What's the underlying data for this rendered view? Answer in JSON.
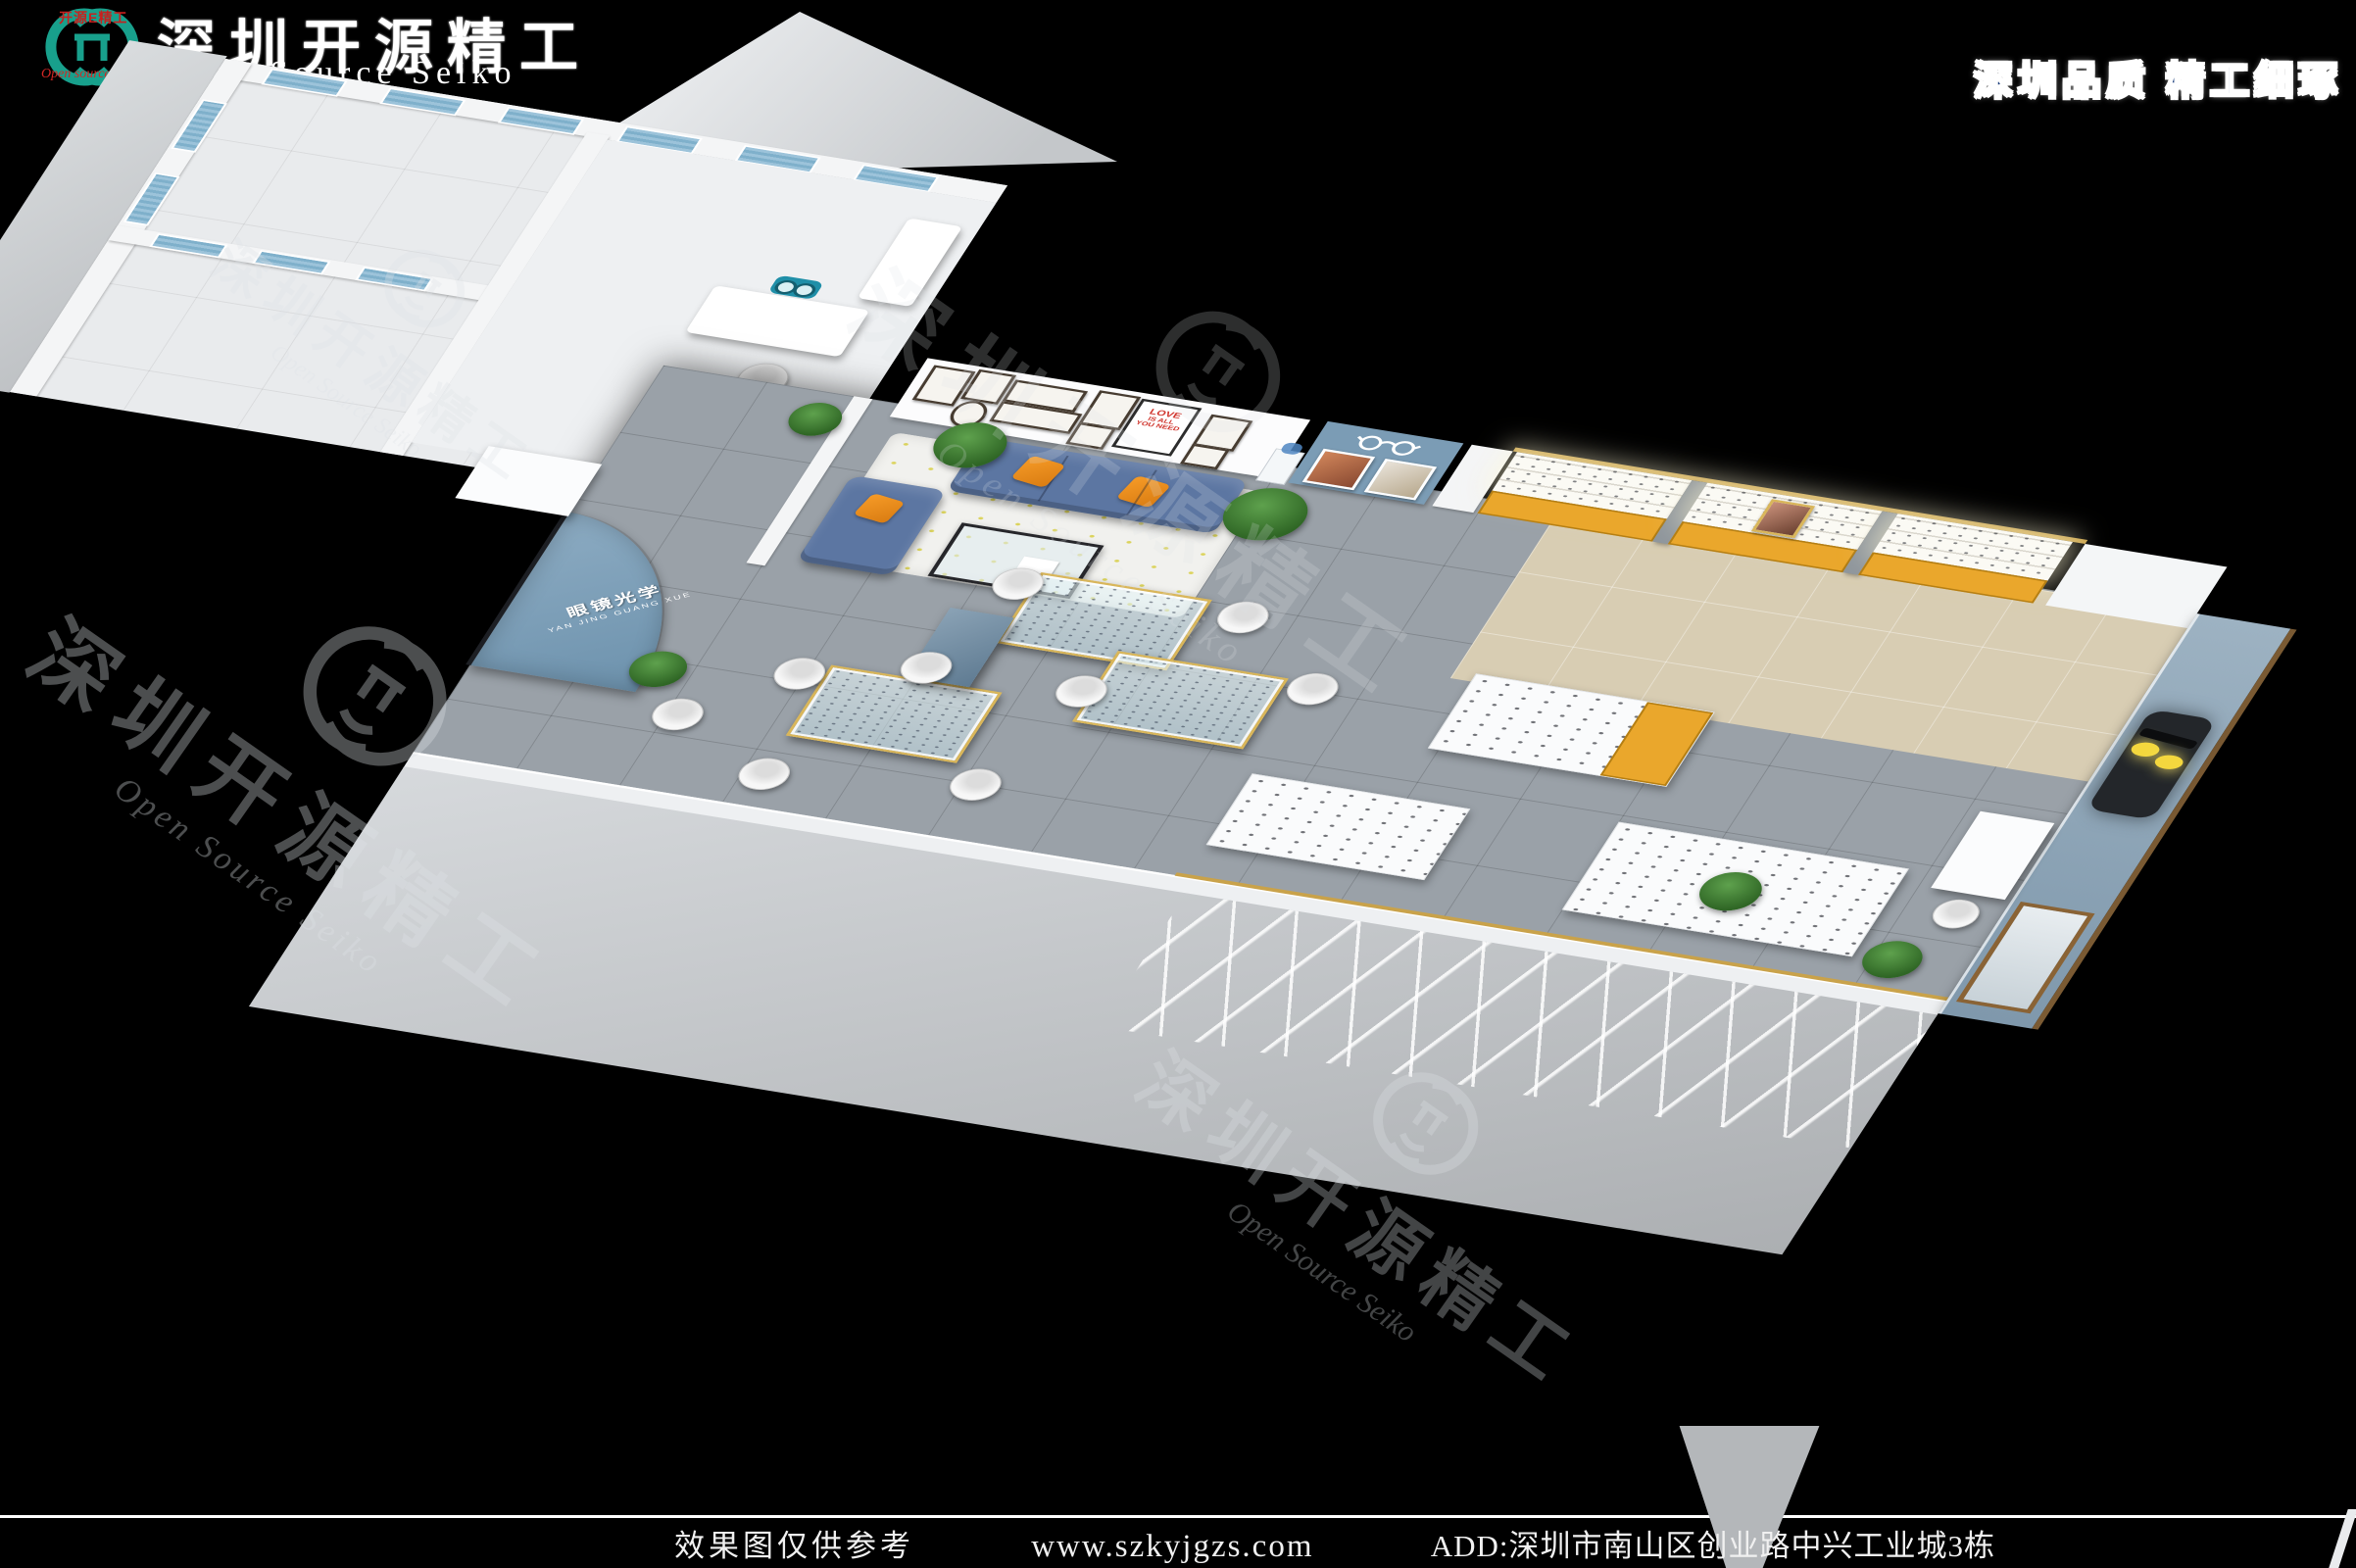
{
  "header": {
    "logo": {
      "seal_text": "开源E精工",
      "sub_text": "Open source Seiko",
      "monogram_color": "#18a08c",
      "seal_color": "#c8201e"
    },
    "title_cn": "深圳开源精工",
    "title_en": "Open Source Seiko",
    "slogan": "深圳品质 精工细琢"
  },
  "watermark": {
    "cn": "深圳开源精工",
    "en": "Open Source Seiko"
  },
  "scene": {
    "entrance_sign": {
      "cn": "眼镜光学",
      "pinyin": "YAN JING GUANG XUE"
    },
    "love_poster": {
      "line1": "LOVE",
      "line2": "IS ALL",
      "line3": "YOU NEED"
    },
    "palette": {
      "sofa_denim": "#5c76a2",
      "pillow_orange": "#ef8f1f",
      "cabinet_amber": "#eaa72c",
      "feature_wall_blue": "#7b9cb5",
      "window_blue": "#7fb0cb",
      "floor_gray": "#9aa1a8",
      "floor_beige": "#d8cdb3",
      "logo_teal": "#18a08c",
      "pixel_glasses_yellow": "#f4d73e"
    }
  },
  "footer": {
    "disclaimer": "效果图仅供参考",
    "website": "www.szkyjgzs.com",
    "address": "ADD:深圳市南山区创业路中兴工业城3栋"
  }
}
